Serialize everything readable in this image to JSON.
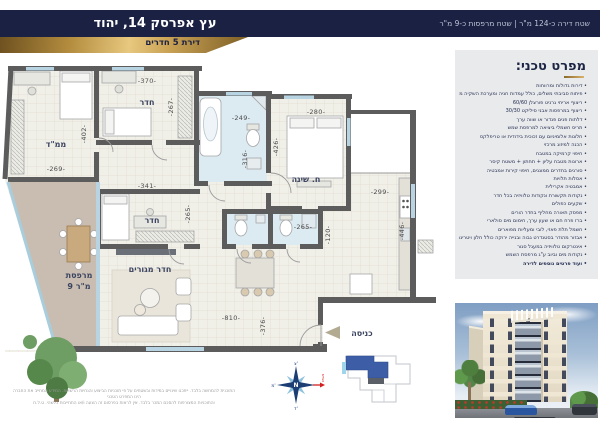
{
  "header": {
    "project_title": "עץ אפרסק 14, יהוד",
    "ribbon_label": "דירת 5 חדרים",
    "areas_label": "שטח דירה כ-124 מ\"ר | שטח מרפסות כ-9 מ\"ר"
  },
  "plan": {
    "rooms": {
      "mamad": "ממ\"ד",
      "room_top": "חדר",
      "master_bedroom": "ח. שינה",
      "room_mid": "חדר",
      "living": "חדר מגורים",
      "balcony_line1": "מרפסת",
      "balcony_line2": "9 מ\"ר",
      "entrance": "כניסה"
    },
    "dims": {
      "mamad_w": "-269-",
      "mamad_h": "-402-",
      "room1_w": "-370-",
      "room1_h": "-267-",
      "bath_w": "-249-",
      "bath_h": "-316-",
      "master_w": "-280-",
      "master_h": "-426-",
      "kitchen_w": "-299-",
      "kitchen_h": "-446-",
      "room2_w": "-341-",
      "room2_h": "-265-",
      "wc_w": "-265-",
      "wc_h": "-120-",
      "living_w": "-810-",
      "living_h": "-376-"
    }
  },
  "spec": {
    "heading": "מפרט טכני:",
    "items": [
      "דירות גדולות ומרווחות",
      "פיתוח סביבתי משלים, כולל עמדות חניה ומערכת השקיה ממוחשבת",
      "ריצוף אריחי גרניט פורצלן 60/60",
      "ריצוף במרפסות אבני סיליקט 30/30",
      "דלתות פנים פנדור או שווה ערך",
      "תריס חשמלי ביציאה למרפסת שמש",
      "חלונות אלומיניום עם זכוכית בידודית או טריפלקס",
      "הכנה למיזוג מרכזי",
      "חיפוי קרמיקה במטבח",
      "ארונות מטבח עליון + תחתון + משטח קיסר",
      "סורגים בחדרים ממוגנים, חיפוי קירות אמבטיה",
      "אסלות תלויות",
      "אמבטיה אקרילית",
      "נקודות תקשורת ונקודות טלוויזיה בכל חדר",
      "שקעים כפולים",
      "מפסק תאורה מחליף בחדר הורים",
      "ברז פרח חם או שעון ערך, חימום מים סולארי",
      "חשמל תלת פאזי, לובי ומעליות מפוארים",
      "אבזור מהודר בסטנדרט גבוה ובנייה ירוקה כולל חלון ויטרינה",
      "אינטרקום טלוויזיה במעגל סגור",
      "נקודות מים וביוב ע\"ג מרפסת השמש",
      "ועוד פרטים נוספים לדירה"
    ]
  },
  "compass": {
    "center": "N",
    "north": "צ'",
    "west": "מ'",
    "south": "ד'",
    "road": "כביש"
  },
  "disclaimer": {
    "line1": "התוכנית להמחשה בלבד. ייתכנו שינויים במידות ובשטחים על פי תוכניות הביצוע והנחיות הרשויות. המידע המחייב את החברה הינו המפרט הטכני",
    "line2": "והתוכניות המצורפות להסכם המכר בלבד. אין לראות בפרסום זה הצעה ו/או התחייבות כלשהי. ט.ל.ח"
  },
  "colors": {
    "navy": "#1b2142",
    "gold": "#c5a254",
    "panel": "#e9eaec",
    "wall": "#5c5c5c",
    "balcony_floor": "#c9bdb2",
    "bath_floor": "#dcebf2",
    "keyplan_blue": "#3d5ea6",
    "road_red": "#d42020"
  }
}
